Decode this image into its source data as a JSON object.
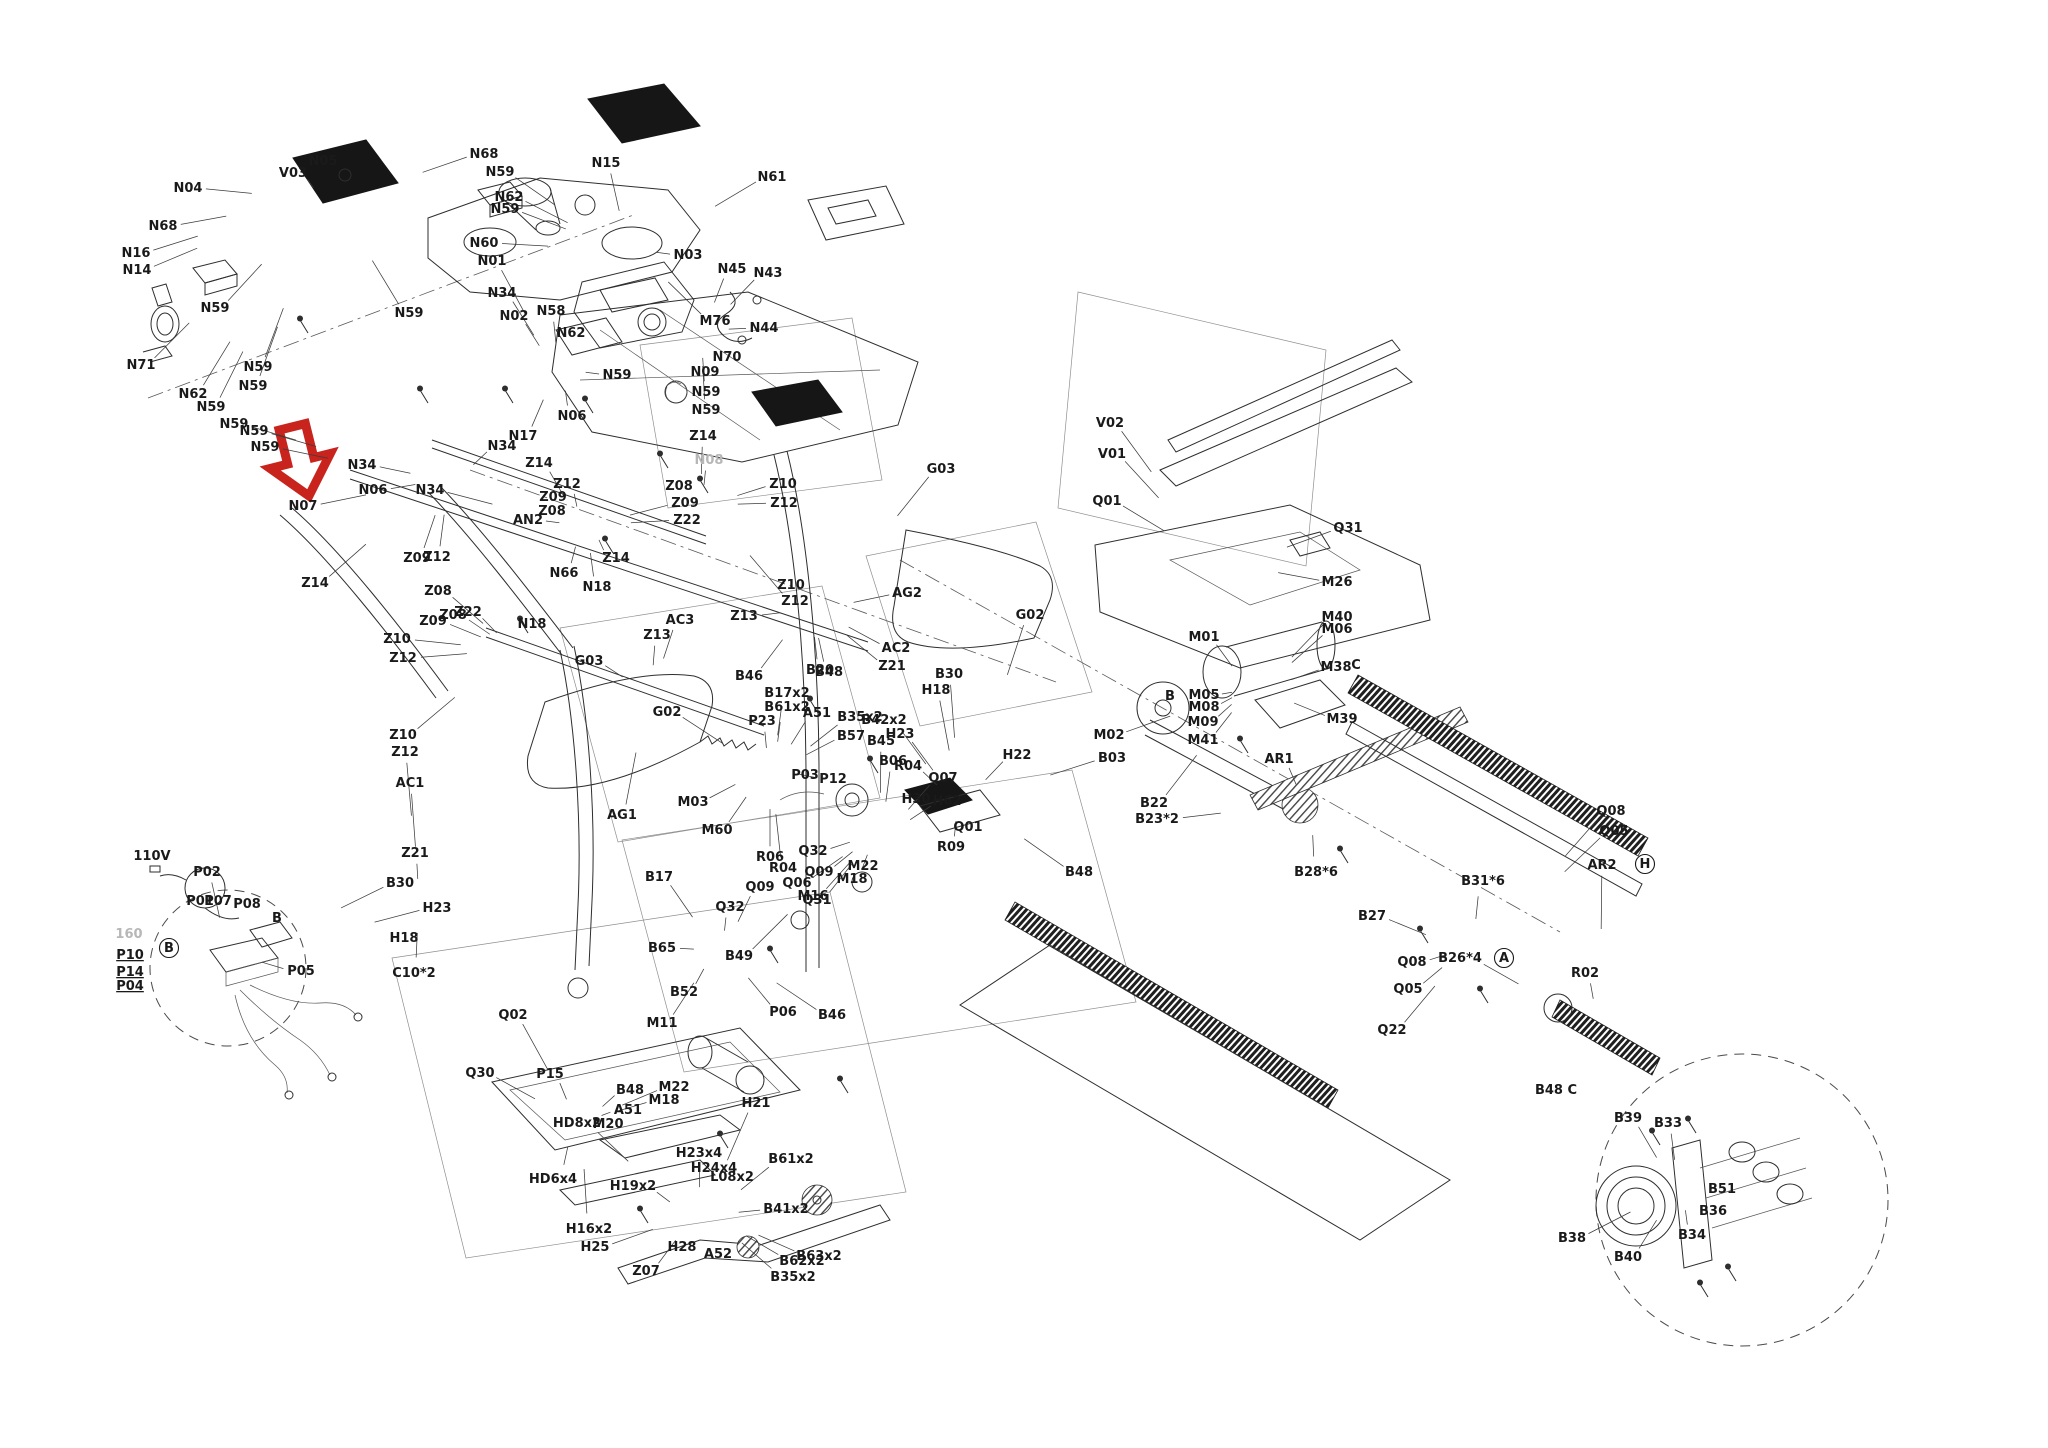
{
  "description": "Exploded parts diagram of a folding treadmill with labeled hardware callouts; a red arrow highlights part N07",
  "highlight": {
    "target_part": "N07",
    "arrow_color": "#c9231d"
  },
  "power_label": "110V",
  "watermark": "160",
  "parts": [
    {
      "id": "N04",
      "x": 188,
      "y": 188
    },
    {
      "id": "N05",
      "x": 323,
      "y": 161
    },
    {
      "id": "V03",
      "x": 293,
      "y": 173
    },
    {
      "id": "N15",
      "x": 606,
      "y": 163
    },
    {
      "id": "N61",
      "x": 772,
      "y": 177
    },
    {
      "id": "N68",
      "x": 484,
      "y": 154
    },
    {
      "id": "N59",
      "x": 500,
      "y": 172
    },
    {
      "id": "N62",
      "x": 509,
      "y": 197
    },
    {
      "id": "N59",
      "x": 505,
      "y": 209
    },
    {
      "id": "N68",
      "x": 163,
      "y": 226
    },
    {
      "id": "N16",
      "x": 136,
      "y": 253
    },
    {
      "id": "N14",
      "x": 137,
      "y": 270
    },
    {
      "id": "N60",
      "x": 484,
      "y": 243
    },
    {
      "id": "N01",
      "x": 492,
      "y": 261
    },
    {
      "id": "N59",
      "x": 215,
      "y": 308
    },
    {
      "id": "N58",
      "x": 551,
      "y": 311
    },
    {
      "id": "N03",
      "x": 688,
      "y": 255
    },
    {
      "id": "N45",
      "x": 732,
      "y": 269
    },
    {
      "id": "N43",
      "x": 768,
      "y": 273
    },
    {
      "id": "N44",
      "x": 764,
      "y": 328
    },
    {
      "id": "M76",
      "x": 715,
      "y": 321
    },
    {
      "id": "N70",
      "x": 727,
      "y": 357
    },
    {
      "id": "N71",
      "x": 141,
      "y": 365
    },
    {
      "id": "N62",
      "x": 193,
      "y": 394
    },
    {
      "id": "N59",
      "x": 258,
      "y": 367
    },
    {
      "id": "N59",
      "x": 253,
      "y": 386
    },
    {
      "id": "N59",
      "x": 211,
      "y": 407
    },
    {
      "id": "N59",
      "x": 234,
      "y": 424
    },
    {
      "id": "N59",
      "x": 254,
      "y": 431
    },
    {
      "id": "N59",
      "x": 265,
      "y": 447
    },
    {
      "id": "N34",
      "x": 502,
      "y": 293
    },
    {
      "id": "N02",
      "x": 514,
      "y": 316
    },
    {
      "id": "N62",
      "x": 571,
      "y": 333
    },
    {
      "id": "N59",
      "x": 409,
      "y": 313
    },
    {
      "id": "N59",
      "x": 617,
      "y": 375
    },
    {
      "id": "N09",
      "x": 705,
      "y": 372
    },
    {
      "id": "N59",
      "x": 706,
      "y": 392
    },
    {
      "id": "N59",
      "x": 706,
      "y": 410
    },
    {
      "id": "N06",
      "x": 572,
      "y": 416
    },
    {
      "id": "N17",
      "x": 523,
      "y": 436
    },
    {
      "id": "N34",
      "x": 502,
      "y": 446
    },
    {
      "id": "N34",
      "x": 362,
      "y": 465
    },
    {
      "id": "N34",
      "x": 430,
      "y": 490
    },
    {
      "id": "N06",
      "x": 373,
      "y": 490
    },
    {
      "id": "N07",
      "x": 303,
      "y": 506
    },
    {
      "id": "Z14",
      "x": 539,
      "y": 463
    },
    {
      "id": "Z14",
      "x": 315,
      "y": 583
    },
    {
      "id": "Z14",
      "x": 616,
      "y": 558
    },
    {
      "id": "Z14",
      "x": 703,
      "y": 436
    },
    {
      "id": "Z12",
      "x": 567,
      "y": 484
    },
    {
      "id": "Z09",
      "x": 553,
      "y": 497
    },
    {
      "id": "Z08",
      "x": 552,
      "y": 511
    },
    {
      "id": "AN2",
      "x": 528,
      "y": 520
    },
    {
      "id": "N66",
      "x": 564,
      "y": 573
    },
    {
      "id": "Z09",
      "x": 417,
      "y": 558
    },
    {
      "id": "Z12",
      "x": 437,
      "y": 557
    },
    {
      "id": "Z08",
      "x": 438,
      "y": 591
    },
    {
      "id": "Z08",
      "x": 453,
      "y": 615
    },
    {
      "id": "Z09",
      "x": 433,
      "y": 621
    },
    {
      "id": "Z22",
      "x": 468,
      "y": 612
    },
    {
      "id": "N18",
      "x": 597,
      "y": 587
    },
    {
      "id": "N18",
      "x": 532,
      "y": 624
    },
    {
      "id": "Z08",
      "x": 679,
      "y": 486
    },
    {
      "id": "Z09",
      "x": 685,
      "y": 503
    },
    {
      "id": "Z22",
      "x": 687,
      "y": 520
    },
    {
      "id": "N08",
      "x": 709,
      "y": 460,
      "faint": true
    },
    {
      "id": "AC3",
      "x": 680,
      "y": 620
    },
    {
      "id": "Z13",
      "x": 744,
      "y": 616
    },
    {
      "id": "Z13",
      "x": 657,
      "y": 635
    },
    {
      "id": "Z10",
      "x": 783,
      "y": 484
    },
    {
      "id": "Z12",
      "x": 784,
      "y": 503
    },
    {
      "id": "Z10",
      "x": 791,
      "y": 585
    },
    {
      "id": "Z12",
      "x": 795,
      "y": 601
    },
    {
      "id": "G03",
      "x": 941,
      "y": 469
    },
    {
      "id": "AG2",
      "x": 907,
      "y": 593
    },
    {
      "id": "G02",
      "x": 1030,
      "y": 615
    },
    {
      "id": "AC2",
      "x": 896,
      "y": 648
    },
    {
      "id": "Z21",
      "x": 892,
      "y": 666
    },
    {
      "id": "B20",
      "x": 820,
      "y": 670
    },
    {
      "id": "B30",
      "x": 949,
      "y": 674
    },
    {
      "id": "H18",
      "x": 936,
      "y": 690
    },
    {
      "id": "H23",
      "x": 900,
      "y": 734
    },
    {
      "id": "P23",
      "x": 762,
      "y": 721
    },
    {
      "id": "G03",
      "x": 589,
      "y": 661
    },
    {
      "id": "G02",
      "x": 667,
      "y": 712
    },
    {
      "id": "Z10",
      "x": 397,
      "y": 639
    },
    {
      "id": "Z12",
      "x": 403,
      "y": 658
    },
    {
      "id": "Z10",
      "x": 403,
      "y": 735
    },
    {
      "id": "Z12",
      "x": 405,
      "y": 752
    },
    {
      "id": "AC1",
      "x": 410,
      "y": 783
    },
    {
      "id": "AG1",
      "x": 622,
      "y": 815
    },
    {
      "id": "P03",
      "x": 805,
      "y": 775
    },
    {
      "id": "P12",
      "x": 833,
      "y": 779
    },
    {
      "id": "M03",
      "x": 693,
      "y": 802
    },
    {
      "id": "M60",
      "x": 717,
      "y": 830
    },
    {
      "id": "H30",
      "x": 916,
      "y": 799
    },
    {
      "id": "H62",
      "x": 947,
      "y": 801
    },
    {
      "id": "R09",
      "x": 951,
      "y": 847
    },
    {
      "id": "H22",
      "x": 1017,
      "y": 755
    },
    {
      "id": "Z21",
      "x": 415,
      "y": 853
    },
    {
      "id": "B30",
      "x": 400,
      "y": 883
    },
    {
      "id": "H23",
      "x": 437,
      "y": 908
    },
    {
      "id": "H18",
      "x": 404,
      "y": 938
    },
    {
      "id": "C10*2",
      "x": 414,
      "y": 973
    },
    {
      "id": "Q32",
      "x": 813,
      "y": 851
    },
    {
      "id": "Q09",
      "x": 819,
      "y": 872
    },
    {
      "id": "M22",
      "x": 863,
      "y": 866
    },
    {
      "id": "M18",
      "x": 852,
      "y": 879
    },
    {
      "id": "M16",
      "x": 813,
      "y": 896
    },
    {
      "id": "Q09",
      "x": 760,
      "y": 887
    },
    {
      "id": "Q32",
      "x": 730,
      "y": 907
    },
    {
      "id": "B46",
      "x": 749,
      "y": 676
    },
    {
      "id": "B48",
      "x": 829,
      "y": 672
    },
    {
      "id": "B17x2",
      "x": 787,
      "y": 693
    },
    {
      "id": "B61x2",
      "x": 787,
      "y": 707
    },
    {
      "id": "A51",
      "x": 817,
      "y": 713
    },
    {
      "id": "B35x2",
      "x": 860,
      "y": 717
    },
    {
      "id": "B42x2",
      "x": 884,
      "y": 720
    },
    {
      "id": "B57",
      "x": 851,
      "y": 736
    },
    {
      "id": "B45",
      "x": 881,
      "y": 741
    },
    {
      "id": "B06",
      "x": 893,
      "y": 761
    },
    {
      "id": "R04",
      "x": 908,
      "y": 766
    },
    {
      "id": "Q07",
      "x": 943,
      "y": 778
    },
    {
      "id": "Q01",
      "x": 968,
      "y": 827
    },
    {
      "id": "R06",
      "x": 770,
      "y": 857
    },
    {
      "id": "R04",
      "x": 783,
      "y": 868
    },
    {
      "id": "Q06",
      "x": 797,
      "y": 883
    },
    {
      "id": "Q31",
      "x": 817,
      "y": 900
    },
    {
      "id": "B17",
      "x": 659,
      "y": 877
    },
    {
      "id": "B65",
      "x": 662,
      "y": 948
    },
    {
      "id": "B49",
      "x": 739,
      "y": 956
    },
    {
      "id": "B52",
      "x": 684,
      "y": 992
    },
    {
      "id": "P06",
      "x": 783,
      "y": 1012
    },
    {
      "id": "B46",
      "x": 832,
      "y": 1015
    },
    {
      "id": "M11",
      "x": 662,
      "y": 1023
    },
    {
      "id": "B48",
      "x": 630,
      "y": 1090
    },
    {
      "id": "Q02",
      "x": 513,
      "y": 1015
    },
    {
      "id": "Q30",
      "x": 480,
      "y": 1073
    },
    {
      "id": "P15",
      "x": 550,
      "y": 1074
    },
    {
      "id": "M22",
      "x": 674,
      "y": 1087
    },
    {
      "id": "M18",
      "x": 664,
      "y": 1100
    },
    {
      "id": "H21",
      "x": 756,
      "y": 1103
    },
    {
      "id": "A51",
      "x": 628,
      "y": 1110
    },
    {
      "id": "M20",
      "x": 608,
      "y": 1124
    },
    {
      "id": "HD8x2",
      "x": 577,
      "y": 1123
    },
    {
      "id": "HD6x4",
      "x": 553,
      "y": 1179
    },
    {
      "id": "H23x4",
      "x": 699,
      "y": 1153
    },
    {
      "id": "H24x4",
      "x": 714,
      "y": 1168
    },
    {
      "id": "L08x2",
      "x": 732,
      "y": 1177
    },
    {
      "id": "H19x2",
      "x": 633,
      "y": 1186
    },
    {
      "id": "B61x2",
      "x": 791,
      "y": 1159
    },
    {
      "id": "B41x2",
      "x": 786,
      "y": 1209
    },
    {
      "id": "H16x2",
      "x": 589,
      "y": 1229
    },
    {
      "id": "H25",
      "x": 595,
      "y": 1247
    },
    {
      "id": "H28",
      "x": 682,
      "y": 1247
    },
    {
      "id": "Z07",
      "x": 646,
      "y": 1271
    },
    {
      "id": "A52",
      "x": 718,
      "y": 1254
    },
    {
      "id": "B62x2",
      "x": 802,
      "y": 1261
    },
    {
      "id": "B63x2",
      "x": 819,
      "y": 1256
    },
    {
      "id": "B35x2",
      "x": 793,
      "y": 1277
    },
    {
      "id": "110V",
      "x": 152,
      "y": 856,
      "no_leader": true
    },
    {
      "id": "P02",
      "x": 207,
      "y": 872
    },
    {
      "id": "P01",
      "x": 200,
      "y": 901,
      "no_leader": true
    },
    {
      "id": "P07",
      "x": 218,
      "y": 901,
      "no_leader": true
    },
    {
      "id": "P08",
      "x": 247,
      "y": 904,
      "no_leader": true
    },
    {
      "id": "B",
      "x": 277,
      "y": 918,
      "no_leader": true
    },
    {
      "id": "160",
      "x": 129,
      "y": 934,
      "faint": true,
      "no_leader": true
    },
    {
      "id": "P10",
      "x": 130,
      "y": 955,
      "underline": true,
      "no_leader": true
    },
    {
      "id": "P14",
      "x": 130,
      "y": 972,
      "underline": true,
      "no_leader": true
    },
    {
      "id": "P04",
      "x": 130,
      "y": 986,
      "underline": true,
      "no_leader": true
    },
    {
      "id": "B",
      "x": 169,
      "y": 948,
      "circled": true,
      "no_leader": true
    },
    {
      "id": "P05",
      "x": 301,
      "y": 971
    },
    {
      "id": "V02",
      "x": 1110,
      "y": 423
    },
    {
      "id": "V01",
      "x": 1112,
      "y": 454
    },
    {
      "id": "Q01",
      "x": 1107,
      "y": 501
    },
    {
      "id": "Q31",
      "x": 1348,
      "y": 528
    },
    {
      "id": "M26",
      "x": 1337,
      "y": 582
    },
    {
      "id": "M40",
      "x": 1337,
      "y": 617
    },
    {
      "id": "M06",
      "x": 1337,
      "y": 629
    },
    {
      "id": "M38",
      "x": 1336,
      "y": 667
    },
    {
      "id": "C",
      "x": 1356,
      "y": 665,
      "no_leader": true
    },
    {
      "id": "M01",
      "x": 1204,
      "y": 637
    },
    {
      "id": "B",
      "x": 1170,
      "y": 696,
      "no_leader": true
    },
    {
      "id": "M05",
      "x": 1204,
      "y": 695
    },
    {
      "id": "M08",
      "x": 1204,
      "y": 707
    },
    {
      "id": "M09",
      "x": 1203,
      "y": 722
    },
    {
      "id": "M41",
      "x": 1203,
      "y": 740
    },
    {
      "id": "M39",
      "x": 1342,
      "y": 719
    },
    {
      "id": "M02",
      "x": 1109,
      "y": 735
    },
    {
      "id": "B03",
      "x": 1112,
      "y": 758
    },
    {
      "id": "AR1",
      "x": 1279,
      "y": 759
    },
    {
      "id": "B22",
      "x": 1154,
      "y": 803
    },
    {
      "id": "B23*2",
      "x": 1157,
      "y": 819
    },
    {
      "id": "B28*6",
      "x": 1316,
      "y": 872
    },
    {
      "id": "B27",
      "x": 1372,
      "y": 916
    },
    {
      "id": "B31*6",
      "x": 1483,
      "y": 881
    },
    {
      "id": "AR2",
      "x": 1602,
      "y": 865
    },
    {
      "id": "H",
      "x": 1645,
      "y": 864,
      "circled": true,
      "no_leader": true
    },
    {
      "id": "Q08",
      "x": 1611,
      "y": 811
    },
    {
      "id": "Q05",
      "x": 1614,
      "y": 831
    },
    {
      "id": "B26*4",
      "x": 1460,
      "y": 958
    },
    {
      "id": "Q08",
      "x": 1412,
      "y": 962
    },
    {
      "id": "Q05",
      "x": 1408,
      "y": 989
    },
    {
      "id": "Q22",
      "x": 1392,
      "y": 1030
    },
    {
      "id": "A",
      "x": 1504,
      "y": 958,
      "circled": true,
      "no_leader": true
    },
    {
      "id": "R02",
      "x": 1585,
      "y": 973
    },
    {
      "id": "B48",
      "x": 1079,
      "y": 872
    },
    {
      "id": "B48 C",
      "x": 1556,
      "y": 1090,
      "no_leader": true
    },
    {
      "id": "B39",
      "x": 1628,
      "y": 1118
    },
    {
      "id": "B33",
      "x": 1668,
      "y": 1123
    },
    {
      "id": "B51",
      "x": 1722,
      "y": 1189
    },
    {
      "id": "B36",
      "x": 1713,
      "y": 1211
    },
    {
      "id": "B34",
      "x": 1692,
      "y": 1235
    },
    {
      "id": "B38",
      "x": 1572,
      "y": 1238
    },
    {
      "id": "B40",
      "x": 1628,
      "y": 1257
    }
  ]
}
